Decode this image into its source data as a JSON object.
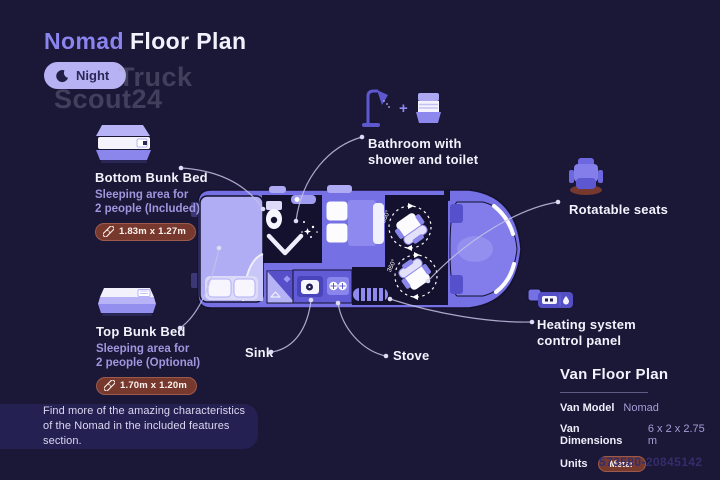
{
  "header": {
    "title_accent": "Nomad",
    "title_rest": "Floor Plan",
    "mode_label": "Night",
    "watermark_line1": "Truck",
    "watermark_line2": "Scout24"
  },
  "annotations": {
    "bottom_bunk": {
      "title": "Bottom Bunk Bed",
      "subtitle_line1": "Sleeping area for",
      "subtitle_line2": "2 people (Included)",
      "dimensions": "1.83m x 1.27m"
    },
    "top_bunk": {
      "title": "Top Bunk Bed",
      "subtitle_line1": "Sleeping area for",
      "subtitle_line2": "2 people (Optional)",
      "dimensions": "1.70m x 1.20m"
    },
    "bathroom": {
      "line1": "Bathroom with",
      "line2": "shower and toilet"
    },
    "rotatable_seats": {
      "label": "Rotatable seats"
    },
    "heating": {
      "line1": "Heating system",
      "line2": "control panel"
    },
    "sink": {
      "label": "Sink"
    },
    "stove": {
      "label": "Stove"
    }
  },
  "floor_plan": {
    "rotation_label": "360°"
  },
  "info_panel": {
    "title": "Van Floor Plan",
    "rows": [
      {
        "label": "Van Model",
        "value": "Nomad"
      },
      {
        "label": "Van Dimensions",
        "value": "6 x 2 x 2.75 m"
      },
      {
        "label": "Units",
        "value": "Meter"
      }
    ]
  },
  "footer_note": {
    "line1": "Find more of the amazing characteristics",
    "line2": "of the Nomad in the included features section."
  },
  "listing_id": "573580-20845142",
  "colors": {
    "background": "#1a1737",
    "accent_purple": "#8b84ee",
    "van_body": "#7570e3",
    "light_lavender": "#b1adf5",
    "interior_dark": "#14112e",
    "badge_brown": "#77392e",
    "night_button": "#b6b2f4",
    "subtext": "#9e97dd",
    "text_white": "#f4f2fd"
  }
}
